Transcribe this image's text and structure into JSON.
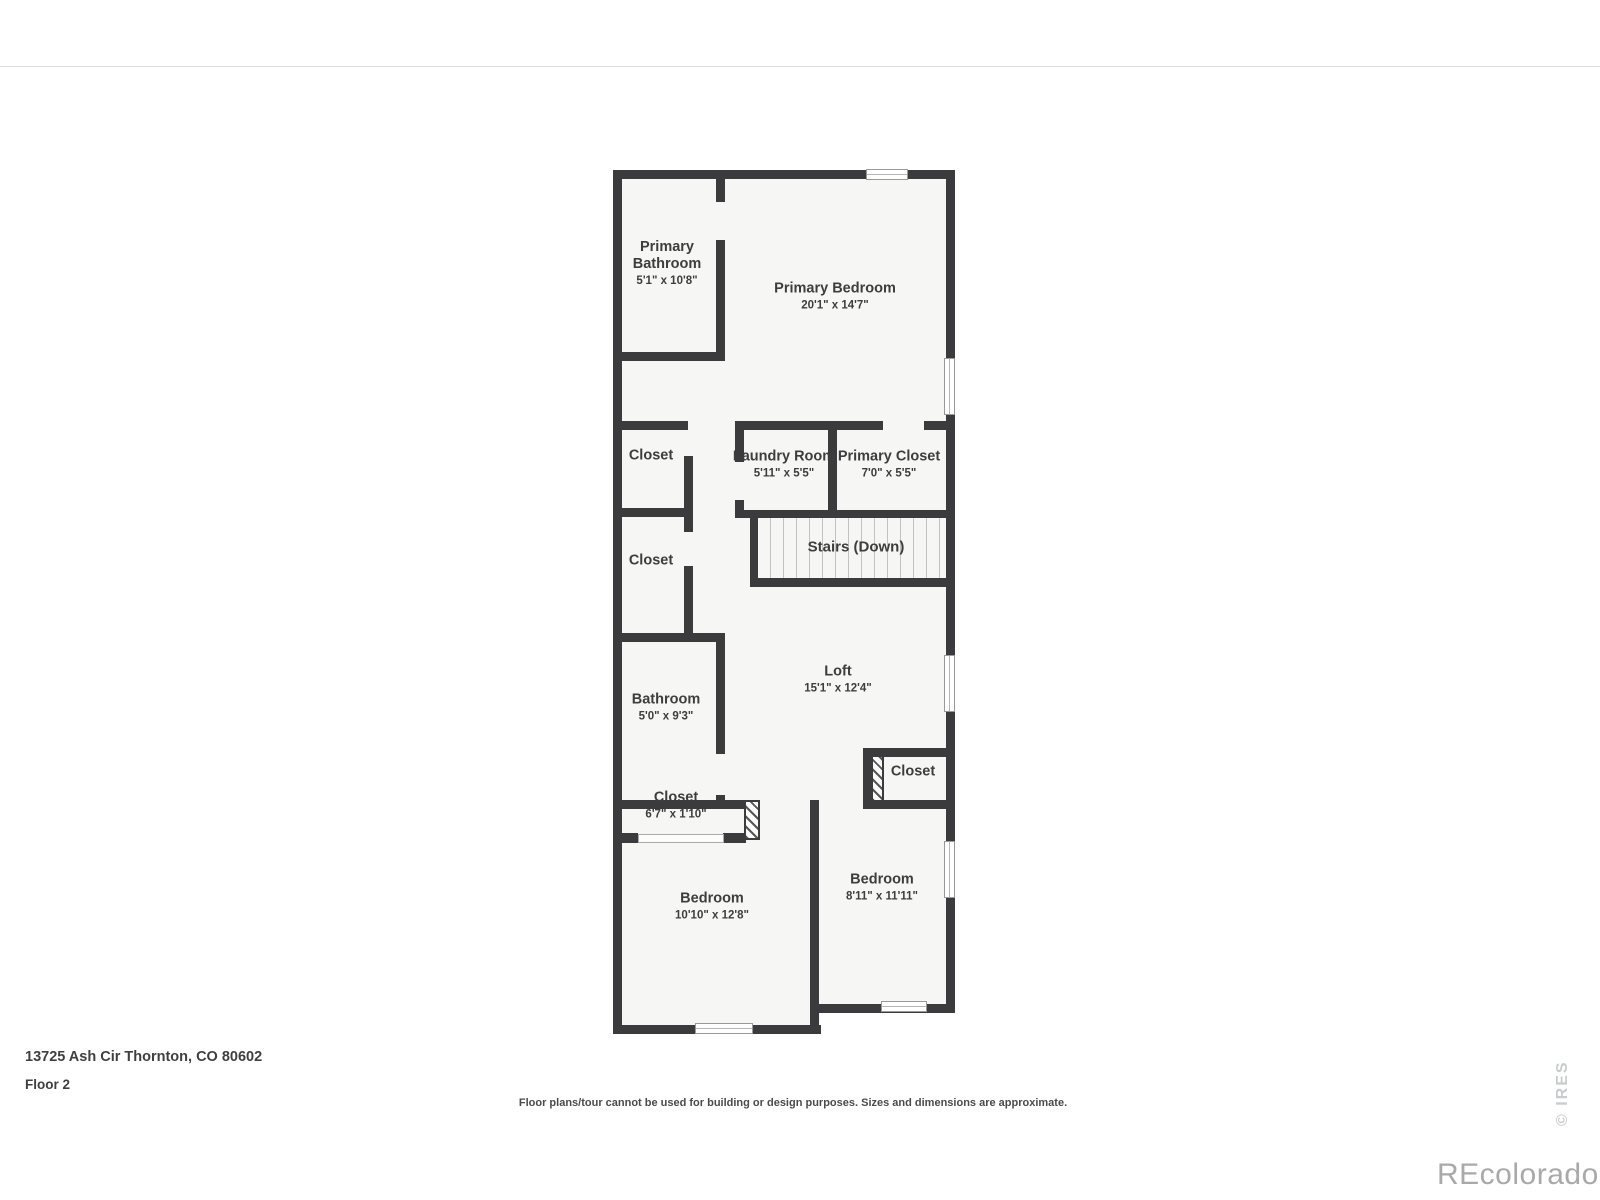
{
  "colors": {
    "wall": "#3b3b3d",
    "floor": "#f6f6f5",
    "label": "#3d3d3d",
    "window_frame": "#999999",
    "tread_line": "#c2c2c2",
    "top_rule": "#dcdcdc",
    "watermark_gray": "#a9a9a9",
    "ires_gray": "#c9cccd"
  },
  "rooms": [
    {
      "name": "Primary Bathroom",
      "dims": "5'1\" x 10'8\""
    },
    {
      "name": "Primary Bedroom",
      "dims": "20'1\" x 14'7\""
    },
    {
      "name": "Closet"
    },
    {
      "name": "Laundry Room",
      "dims": "5'11\" x 5'5\""
    },
    {
      "name": "Primary Closet",
      "dims": "7'0\" x 5'5\""
    },
    {
      "name": "Closet"
    },
    {
      "name": "Stairs (Down)"
    },
    {
      "name": "Bathroom",
      "dims": "5'0\" x 9'3\""
    },
    {
      "name": "Loft",
      "dims": "15'1\" x 12'4\""
    },
    {
      "name": "Closet"
    },
    {
      "name": "Closet",
      "dims": "6'7\" x 1'10\""
    },
    {
      "name": "Bedroom",
      "dims": "10'10\" x 12'8\""
    },
    {
      "name": "Bedroom",
      "dims": "8'11\" x 11'11\""
    }
  ],
  "footer": {
    "address": "13725 Ash Cir Thornton, CO 80602",
    "floor_label": "Floor 2",
    "disclaimer": "Floor plans/tour cannot be used for building or design purposes. Sizes and dimensions are approximate."
  },
  "watermarks": {
    "brand": "REcolorado",
    "ires": "© IRES"
  }
}
